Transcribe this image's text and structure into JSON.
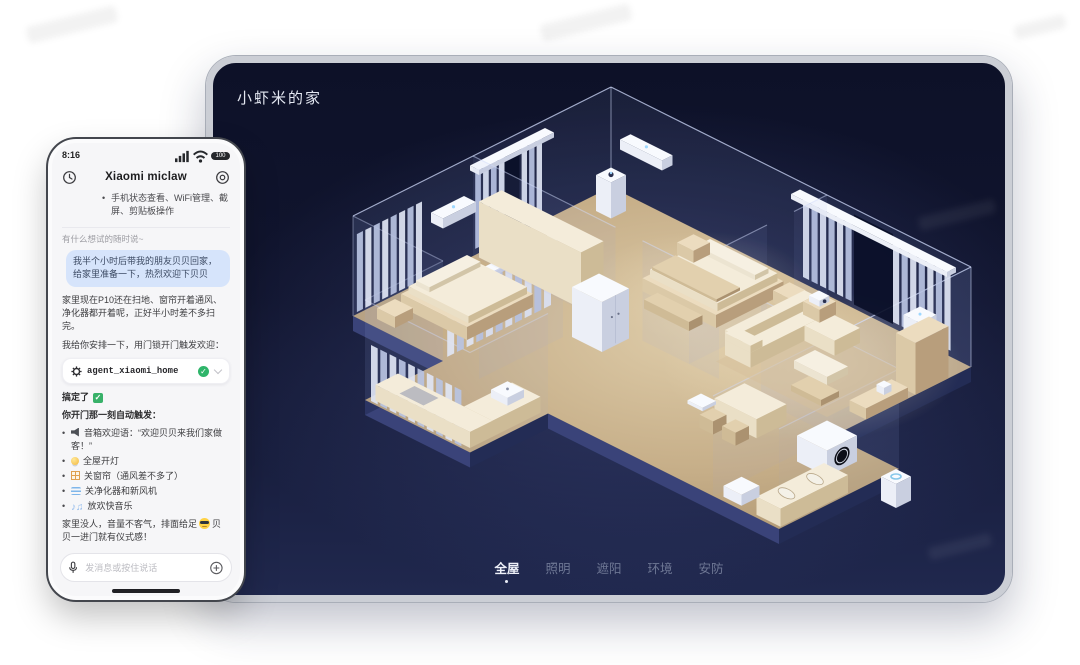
{
  "tablet": {
    "home_title": "小虾米的家",
    "tabs": [
      {
        "label": "全屋",
        "active": true
      },
      {
        "label": "照明",
        "active": false
      },
      {
        "label": "遮阳",
        "active": false
      },
      {
        "label": "环境",
        "active": false
      },
      {
        "label": "安防",
        "active": false
      }
    ],
    "floorplan_rooms": [
      "主卧",
      "次卧",
      "厨房",
      "卫生间",
      "客厅"
    ],
    "devices_3d": [
      "空调",
      "窗帘",
      "空气净化器",
      "冰箱",
      "洗衣机",
      "摄像机",
      "新风机",
      "扫地机器人",
      "立式空调",
      "电饭煲"
    ]
  },
  "phone": {
    "status": {
      "time": "8:16",
      "battery": "100"
    },
    "header": {
      "title": "Xiaomi miclaw"
    },
    "intro_bullet": "手机状态查看、WiFi管理、截屏、剪贴板操作",
    "hint": "有什么想试的随时说~",
    "user_message": "我半个小时后带我的朋友贝贝回家，给家里准备一下，热烈欢迎下贝贝",
    "reply_1": "家里现在P10还在扫地、窗帘开着通风、净化器都开着呢，正好半小时差不多扫完。",
    "reply_2": "我给你安排一下，用门锁开门触发欢迎：",
    "agent_card": {
      "name": "agent_xiaomi_home"
    },
    "done_text": "搞定了",
    "trigger_heading": "你开门那一刻自动触发：",
    "triggers": [
      {
        "icon": "speaker",
        "text": "音箱欢迎语：“欢迎贝贝来我们家做客！”"
      },
      {
        "icon": "bulb",
        "text": "全屋开灯"
      },
      {
        "icon": "window",
        "text": "关窗帘（通风差不多了）"
      },
      {
        "icon": "wind",
        "text": "关净化器和新风机"
      },
      {
        "icon": "music",
        "text": "放欢快音乐"
      }
    ],
    "closing_pre": "家里没人，音量不客气，排面给足",
    "closing_post": "贝贝一进门就有仪式感！",
    "input_placeholder": "发消息或按住说话"
  },
  "colors": {
    "tablet_bg_top": "#0d1128",
    "tablet_bg_bottom": "#20284e",
    "floor_beige": "#c9b28e",
    "furniture_cream": "#ecdcbf",
    "device_white": "#f6f8fc",
    "bubble_blue": "#d6e4fb",
    "check_green": "#2fb56a",
    "tab_active": "#eef1f9",
    "tab_inactive": "#6e7794"
  }
}
